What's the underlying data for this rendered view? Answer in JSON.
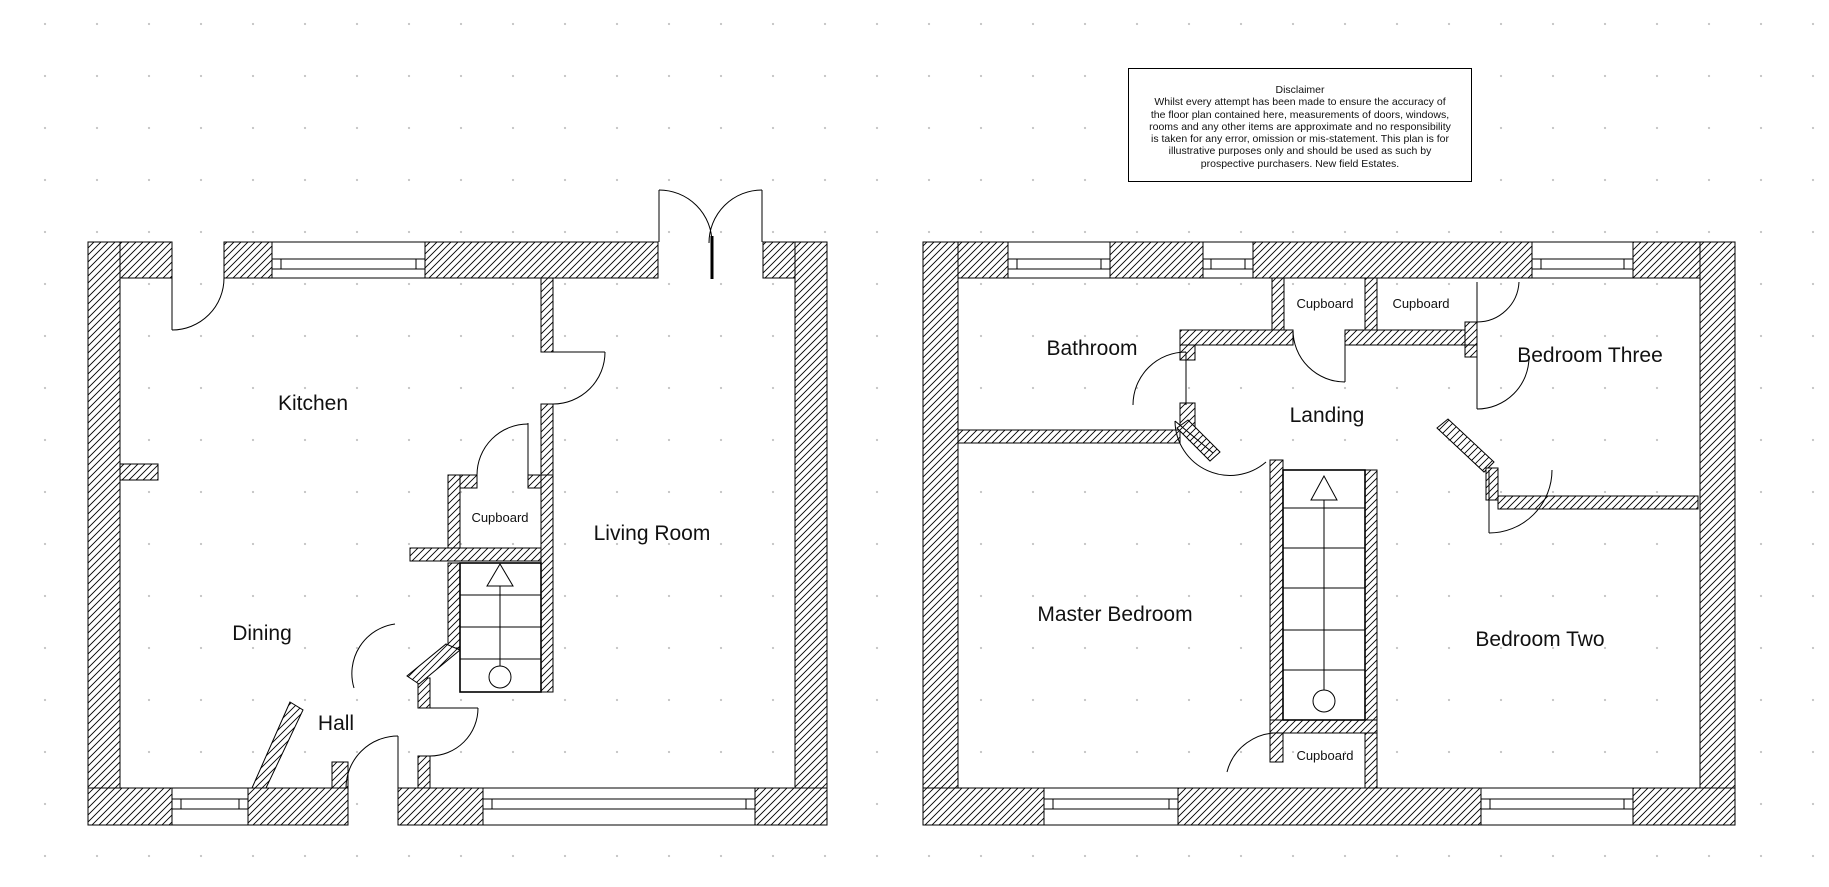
{
  "disclaimer": {
    "title": "Disclaimer",
    "lines": [
      "Whilst every attempt has been made to ensure the accuracy of",
      "the floor plan contained here, measurements of doors, windows,",
      "rooms and any other items are approximate and no responsibility",
      "is taken for any error, omission or mis-statement. This plan is for",
      "illustrative purposes only and should be used as such by",
      "prospective purchasers. New field Estates."
    ]
  },
  "ground_floor": {
    "rooms": {
      "kitchen": "Kitchen",
      "dining": "Dining",
      "hall": "Hall",
      "living_room": "Living Room",
      "cupboard": "Cupboard"
    }
  },
  "first_floor": {
    "rooms": {
      "bathroom": "Bathroom",
      "landing": "Landing",
      "bedroom_three": "Bedroom Three",
      "master_bedroom": "Master Bedroom",
      "bedroom_two": "Bedroom Two",
      "cupboard_top_left": "Cupboard",
      "cupboard_top_right": "Cupboard",
      "cupboard_bottom": "Cupboard"
    }
  },
  "colors": {
    "wall": "#000000",
    "background": "#ffffff",
    "grid_dot": "#c9c9c9"
  }
}
